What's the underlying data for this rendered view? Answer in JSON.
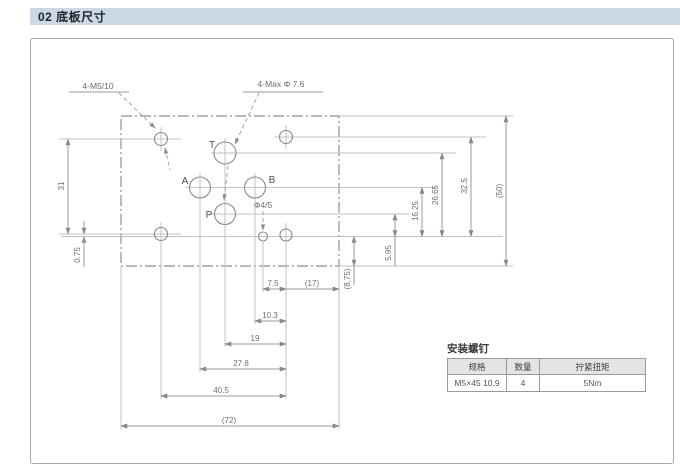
{
  "header": {
    "title": "02 底板尺寸"
  },
  "drawing": {
    "callouts": {
      "bolt_holes": "4-M5/10",
      "ports_max": "4-Max Φ 7.6",
      "pin_hole": "Φ4/5"
    },
    "ports": {
      "t": "T",
      "a": "A",
      "b": "B",
      "p": "P"
    },
    "dims": {
      "left_vertical": "31",
      "left_offset": "0.75",
      "right_p_row": "5.95",
      "right_ab_row": "16.25",
      "right_t_row": "26.65",
      "right_bolt_row": "32.5",
      "right_overall": "(50)",
      "right_bottom_margin": "(8.75)",
      "bottom_pin": "7.5",
      "bottom_edge": "(17)",
      "bottom_b": "10.3",
      "bottom_p": "19",
      "bottom_a": "27.8",
      "bottom_bolts": "40.5",
      "bottom_overall": "(72)"
    }
  },
  "table": {
    "title": "安装螺钉",
    "headers": [
      "规格",
      "数量",
      "拧紧扭矩"
    ],
    "row": [
      "M5×45 10.9",
      "4",
      "5Nm"
    ]
  }
}
